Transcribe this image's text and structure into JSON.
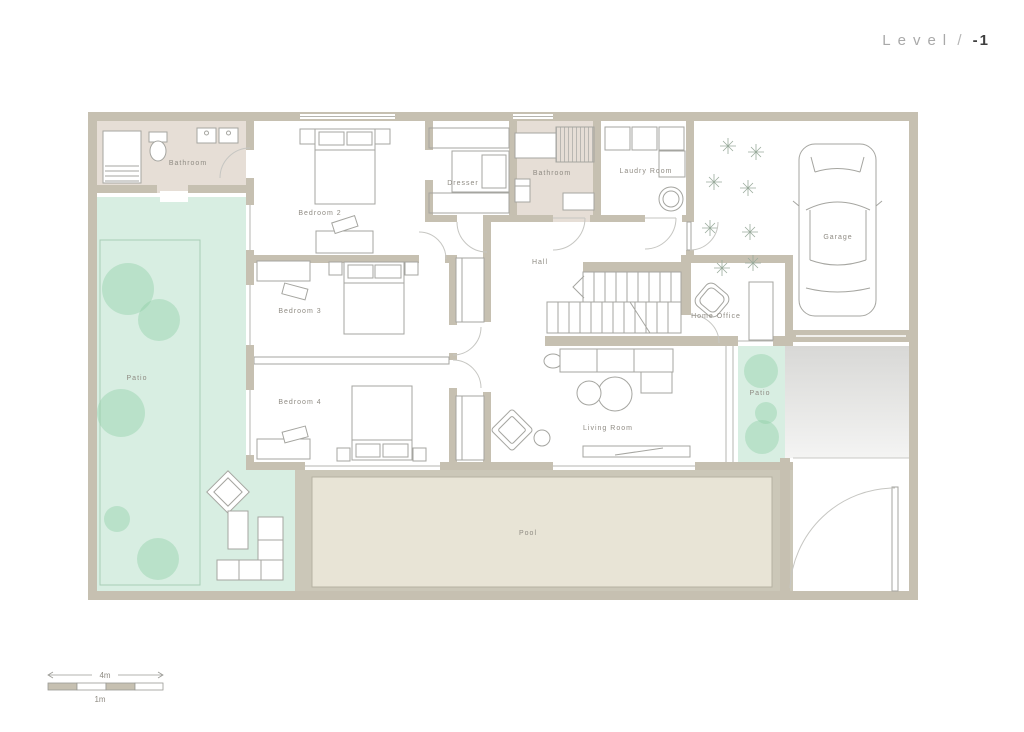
{
  "title": {
    "text": "Level",
    "separator": "/",
    "number": "-1"
  },
  "rooms": {
    "bathroom1": "Bathroom",
    "bedroom2": "Bedroom 2",
    "dresser": "Dresser",
    "bathroom2": "Bathroom",
    "laundry_room": "Laudry Room",
    "garage": "Garage",
    "hall": "Hall",
    "home_office": "Home Office",
    "bedroom3": "Bedroom 3",
    "bedroom4": "Bedroom 4",
    "living_room": "Living Room",
    "patio_left": "Patio",
    "patio_right": "Patio",
    "pool": "Pool"
  },
  "scale_bar": {
    "major_label": "4m",
    "minor_label": "1m"
  },
  "colors": {
    "wall": "#c6c0b1",
    "bathroom_floor": "#e6ded6",
    "patio_green": "#d8eee2",
    "tree_green": "#b2dec4",
    "pool_deck": "#cbc7b8",
    "pool_water": "#e8e4d6",
    "driveway_top": "#d8d8d6",
    "driveway_bottom": "#f4f4f3",
    "label_gray": "#8f8b83",
    "title_gray": "#a9a9a9",
    "title_dark": "#3f3f3f"
  }
}
